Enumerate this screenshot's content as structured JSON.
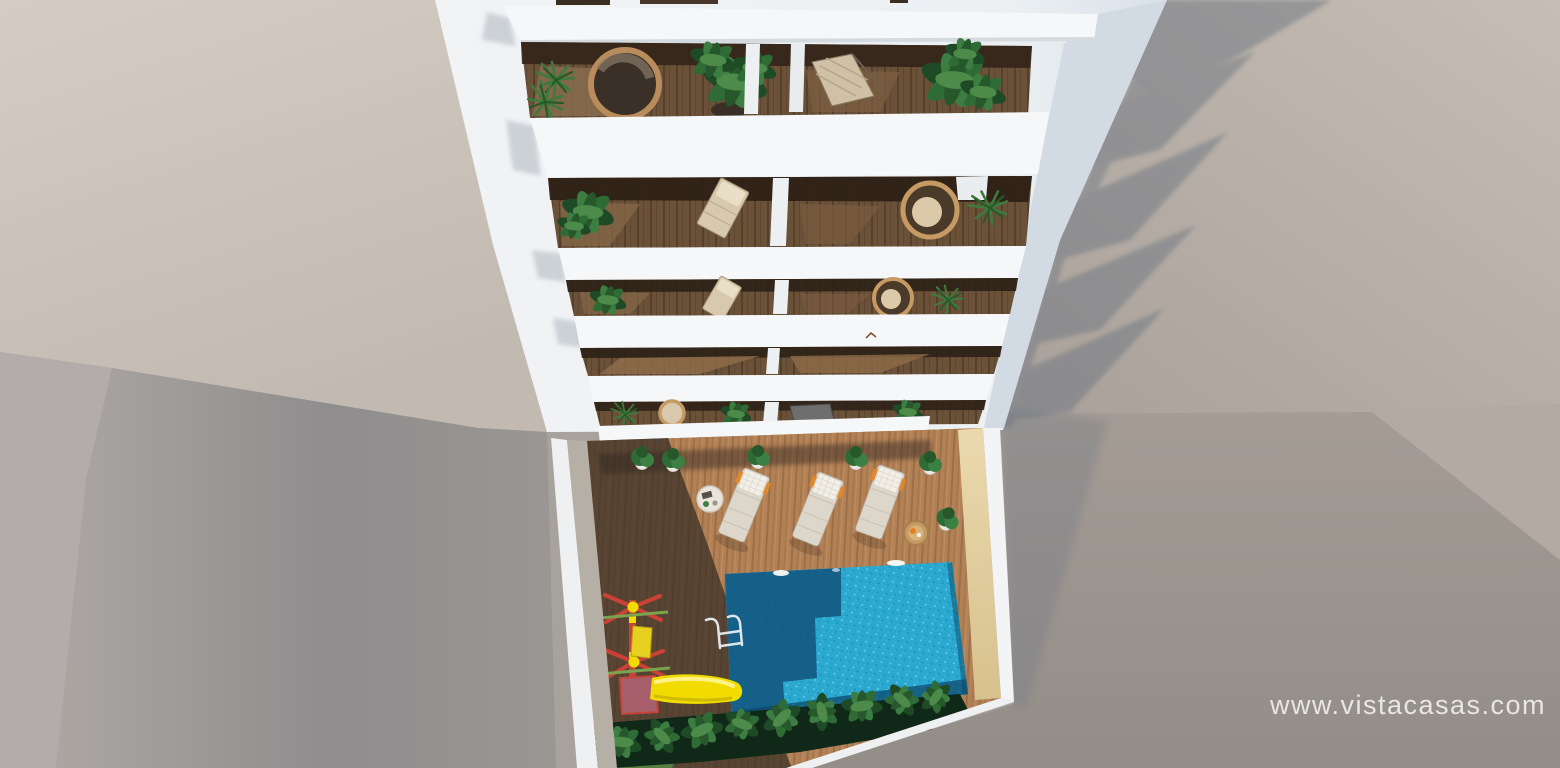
{
  "meta": {
    "type": "3d-architectural-render",
    "view": "aerial-top-down",
    "subject": "white apartment building with stacked balconies above a communal courtyard with swimming pool, sun deck and children's playground"
  },
  "watermark": {
    "text": "www.vistacasas.com"
  },
  "palette": {
    "beige_wall": "#cdc5bb",
    "beige_wall_right": "#b7afa7",
    "gray_wall": "#a39d97",
    "gray_wall_dark": "#918b86",
    "building_white": "#eef1f4",
    "slab_white": "#f6f7f8",
    "wood_dark": "#6b5138",
    "wood_lit": "#8b6e50",
    "deck_lit": "#b28156",
    "deck_shadow": "#352c24",
    "pool_lit": "#2aa8cf",
    "pool_shadow": "#12557f",
    "pool_deep": "#0d4569",
    "cream_wall": "#e2d0a2",
    "plant_green": "#2f6b35",
    "plant_dark": "#0f2817",
    "grass_green": "#567f3f",
    "slide_yellow": "#f2dc00",
    "frame_red": "#cc4136",
    "platform_mauve": "#a85f6c",
    "lounger_cushion": "#ddd6cb",
    "lounger_pillow": "#f2efe9",
    "accent_orange": "#e0882c",
    "rattan": "#c59a63",
    "watermark_color": "rgba(255,255,255,0.78)"
  },
  "scene": {
    "balcony_rows": 5,
    "balconies_per_row": 2,
    "sun_loungers": 3,
    "side_tables": 2,
    "potted_plants": 6,
    "pools": 1,
    "playground": {
      "slide_color": "yellow",
      "frame_color": "red"
    }
  }
}
